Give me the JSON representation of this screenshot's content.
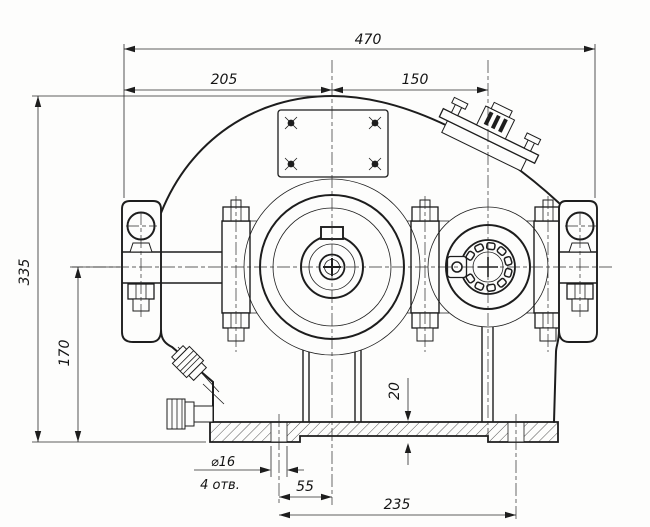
{
  "drawing": {
    "dims": {
      "overall_width": "470",
      "left_span": "205",
      "right_span": "150",
      "overall_height": "335",
      "axis_height": "170",
      "base_thickness": "20",
      "hole_offset": "55",
      "hole_pitch": "235",
      "hole_dia": "⌀16",
      "hole_qty": "4 отв."
    }
  }
}
